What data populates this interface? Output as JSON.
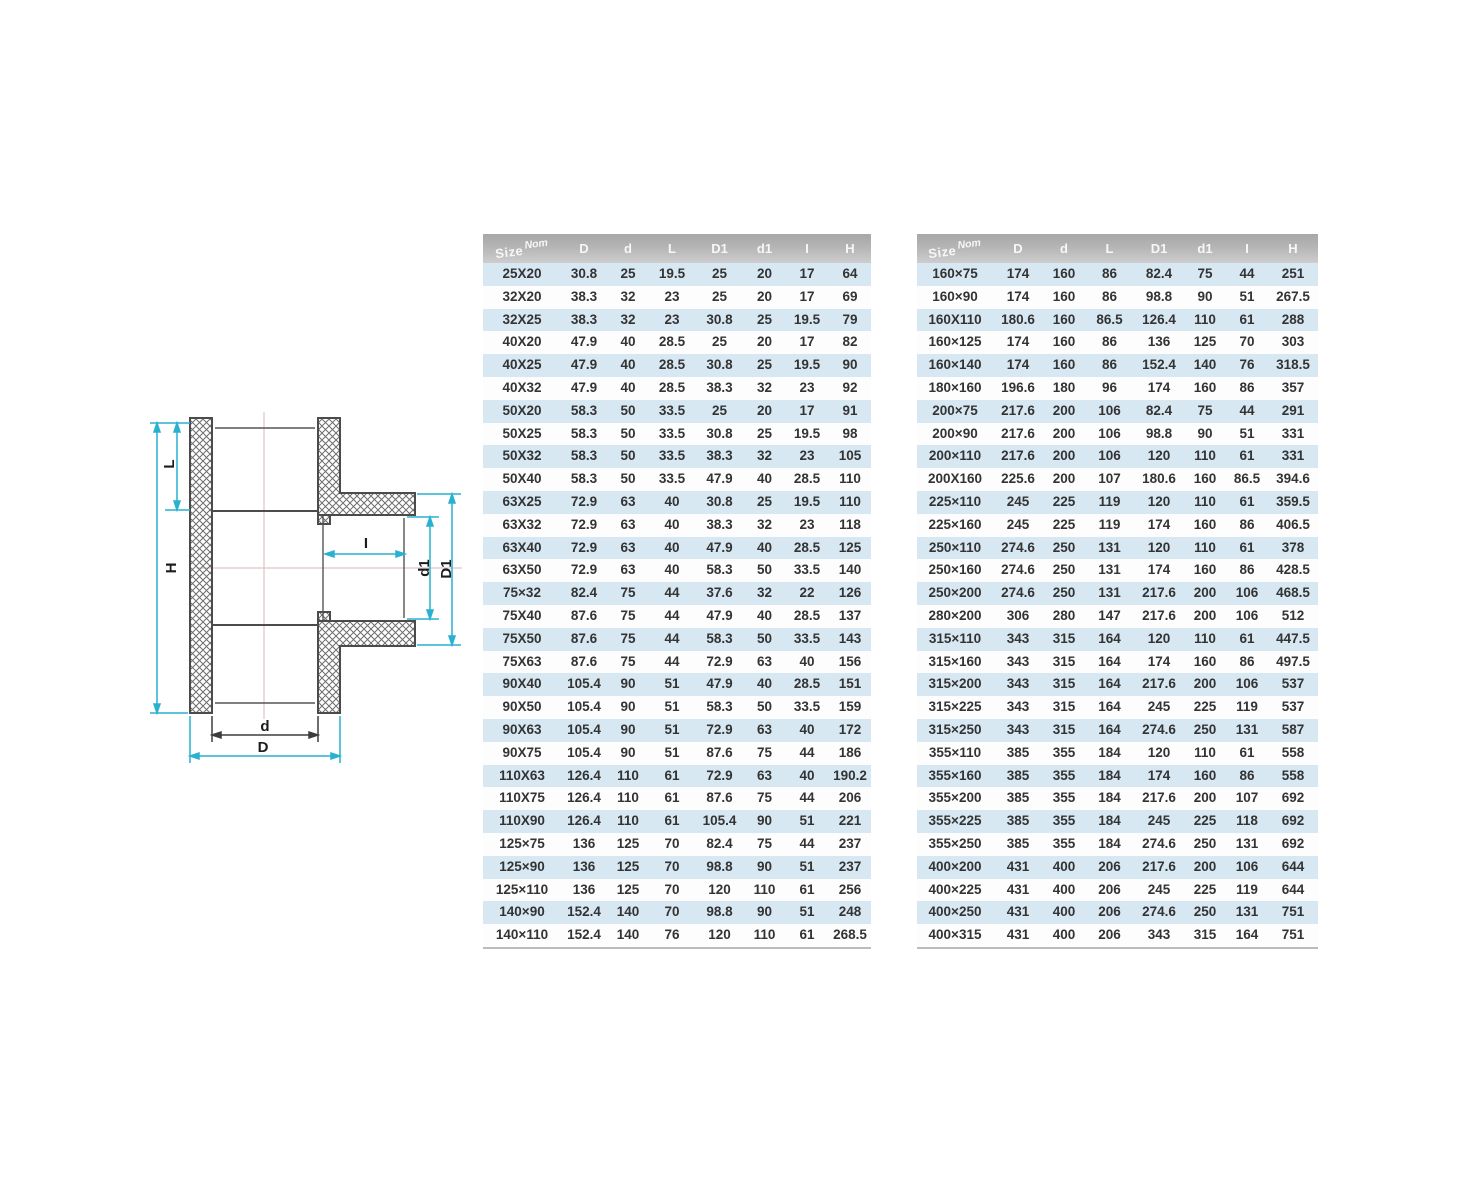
{
  "diagram": {
    "labels": {
      "L": "L",
      "H": "H",
      "I": "I",
      "d1": "d1",
      "D1": "D1",
      "d": "d",
      "D": "D"
    },
    "colors": {
      "dimension": "#29b1cf",
      "dark_dimension": "#3d3d3d",
      "outline": "#4b4b4b",
      "centerline": "#d9c6c6"
    }
  },
  "tables": [
    {
      "size_header": {
        "main": "Size",
        "sup": "Nom"
      },
      "headers": [
        "D",
        "d",
        "L",
        "D1",
        "d1",
        "I",
        "H"
      ],
      "rows": [
        [
          "25X20",
          "30.8",
          "25",
          "19.5",
          "25",
          "20",
          "17",
          "64"
        ],
        [
          "32X20",
          "38.3",
          "32",
          "23",
          "25",
          "20",
          "17",
          "69"
        ],
        [
          "32X25",
          "38.3",
          "32",
          "23",
          "30.8",
          "25",
          "19.5",
          "79"
        ],
        [
          "40X20",
          "47.9",
          "40",
          "28.5",
          "25",
          "20",
          "17",
          "82"
        ],
        [
          "40X25",
          "47.9",
          "40",
          "28.5",
          "30.8",
          "25",
          "19.5",
          "90"
        ],
        [
          "40X32",
          "47.9",
          "40",
          "28.5",
          "38.3",
          "32",
          "23",
          "92"
        ],
        [
          "50X20",
          "58.3",
          "50",
          "33.5",
          "25",
          "20",
          "17",
          "91"
        ],
        [
          "50X25",
          "58.3",
          "50",
          "33.5",
          "30.8",
          "25",
          "19.5",
          "98"
        ],
        [
          "50X32",
          "58.3",
          "50",
          "33.5",
          "38.3",
          "32",
          "23",
          "105"
        ],
        [
          "50X40",
          "58.3",
          "50",
          "33.5",
          "47.9",
          "40",
          "28.5",
          "110"
        ],
        [
          "63X25",
          "72.9",
          "63",
          "40",
          "30.8",
          "25",
          "19.5",
          "110"
        ],
        [
          "63X32",
          "72.9",
          "63",
          "40",
          "38.3",
          "32",
          "23",
          "118"
        ],
        [
          "63X40",
          "72.9",
          "63",
          "40",
          "47.9",
          "40",
          "28.5",
          "125"
        ],
        [
          "63X50",
          "72.9",
          "63",
          "40",
          "58.3",
          "50",
          "33.5",
          "140"
        ],
        [
          "75×32",
          "82.4",
          "75",
          "44",
          "37.6",
          "32",
          "22",
          "126"
        ],
        [
          "75X40",
          "87.6",
          "75",
          "44",
          "47.9",
          "40",
          "28.5",
          "137"
        ],
        [
          "75X50",
          "87.6",
          "75",
          "44",
          "58.3",
          "50",
          "33.5",
          "143"
        ],
        [
          "75X63",
          "87.6",
          "75",
          "44",
          "72.9",
          "63",
          "40",
          "156"
        ],
        [
          "90X40",
          "105.4",
          "90",
          "51",
          "47.9",
          "40",
          "28.5",
          "151"
        ],
        [
          "90X50",
          "105.4",
          "90",
          "51",
          "58.3",
          "50",
          "33.5",
          "159"
        ],
        [
          "90X63",
          "105.4",
          "90",
          "51",
          "72.9",
          "63",
          "40",
          "172"
        ],
        [
          "90X75",
          "105.4",
          "90",
          "51",
          "87.6",
          "75",
          "44",
          "186"
        ],
        [
          "110X63",
          "126.4",
          "110",
          "61",
          "72.9",
          "63",
          "40",
          "190.2"
        ],
        [
          "110X75",
          "126.4",
          "110",
          "61",
          "87.6",
          "75",
          "44",
          "206"
        ],
        [
          "110X90",
          "126.4",
          "110",
          "61",
          "105.4",
          "90",
          "51",
          "221"
        ],
        [
          "125×75",
          "136",
          "125",
          "70",
          "82.4",
          "75",
          "44",
          "237"
        ],
        [
          "125×90",
          "136",
          "125",
          "70",
          "98.8",
          "90",
          "51",
          "237"
        ],
        [
          "125×110",
          "136",
          "125",
          "70",
          "120",
          "110",
          "61",
          "256"
        ],
        [
          "140×90",
          "152.4",
          "140",
          "70",
          "98.8",
          "90",
          "51",
          "248"
        ],
        [
          "140×110",
          "152.4",
          "140",
          "76",
          "120",
          "110",
          "61",
          "268.5"
        ]
      ]
    },
    {
      "size_header": {
        "main": "Size",
        "sup": "Nom"
      },
      "headers": [
        "D",
        "d",
        "L",
        "D1",
        "d1",
        "I",
        "H"
      ],
      "rows": [
        [
          "160×75",
          "174",
          "160",
          "86",
          "82.4",
          "75",
          "44",
          "251"
        ],
        [
          "160×90",
          "174",
          "160",
          "86",
          "98.8",
          "90",
          "51",
          "267.5"
        ],
        [
          "160X110",
          "180.6",
          "160",
          "86.5",
          "126.4",
          "110",
          "61",
          "288"
        ],
        [
          "160×125",
          "174",
          "160",
          "86",
          "136",
          "125",
          "70",
          "303"
        ],
        [
          "160×140",
          "174",
          "160",
          "86",
          "152.4",
          "140",
          "76",
          "318.5"
        ],
        [
          "180×160",
          "196.6",
          "180",
          "96",
          "174",
          "160",
          "86",
          "357"
        ],
        [
          "200×75",
          "217.6",
          "200",
          "106",
          "82.4",
          "75",
          "44",
          "291"
        ],
        [
          "200×90",
          "217.6",
          "200",
          "106",
          "98.8",
          "90",
          "51",
          "331"
        ],
        [
          "200×110",
          "217.6",
          "200",
          "106",
          "120",
          "110",
          "61",
          "331"
        ],
        [
          "200X160",
          "225.6",
          "200",
          "107",
          "180.6",
          "160",
          "86.5",
          "394.6"
        ],
        [
          "225×110",
          "245",
          "225",
          "119",
          "120",
          "110",
          "61",
          "359.5"
        ],
        [
          "225×160",
          "245",
          "225",
          "119",
          "174",
          "160",
          "86",
          "406.5"
        ],
        [
          "250×110",
          "274.6",
          "250",
          "131",
          "120",
          "110",
          "61",
          "378"
        ],
        [
          "250×160",
          "274.6",
          "250",
          "131",
          "174",
          "160",
          "86",
          "428.5"
        ],
        [
          "250×200",
          "274.6",
          "250",
          "131",
          "217.6",
          "200",
          "106",
          "468.5"
        ],
        [
          "280×200",
          "306",
          "280",
          "147",
          "217.6",
          "200",
          "106",
          "512"
        ],
        [
          "315×110",
          "343",
          "315",
          "164",
          "120",
          "110",
          "61",
          "447.5"
        ],
        [
          "315×160",
          "343",
          "315",
          "164",
          "174",
          "160",
          "86",
          "497.5"
        ],
        [
          "315×200",
          "343",
          "315",
          "164",
          "217.6",
          "200",
          "106",
          "537"
        ],
        [
          "315×225",
          "343",
          "315",
          "164",
          "245",
          "225",
          "119",
          "537"
        ],
        [
          "315×250",
          "343",
          "315",
          "164",
          "274.6",
          "250",
          "131",
          "587"
        ],
        [
          "355×110",
          "385",
          "355",
          "184",
          "120",
          "110",
          "61",
          "558"
        ],
        [
          "355×160",
          "385",
          "355",
          "184",
          "174",
          "160",
          "86",
          "558"
        ],
        [
          "355×200",
          "385",
          "355",
          "184",
          "217.6",
          "200",
          "107",
          "692"
        ],
        [
          "355×225",
          "385",
          "355",
          "184",
          "245",
          "225",
          "118",
          "692"
        ],
        [
          "355×250",
          "385",
          "355",
          "184",
          "274.6",
          "250",
          "131",
          "692"
        ],
        [
          "400×200",
          "431",
          "400",
          "206",
          "217.6",
          "200",
          "106",
          "644"
        ],
        [
          "400×225",
          "431",
          "400",
          "206",
          "245",
          "225",
          "119",
          "644"
        ],
        [
          "400×250",
          "431",
          "400",
          "206",
          "274.6",
          "250",
          "131",
          "751"
        ],
        [
          "400×315",
          "431",
          "400",
          "206",
          "343",
          "315",
          "164",
          "751"
        ]
      ]
    }
  ]
}
